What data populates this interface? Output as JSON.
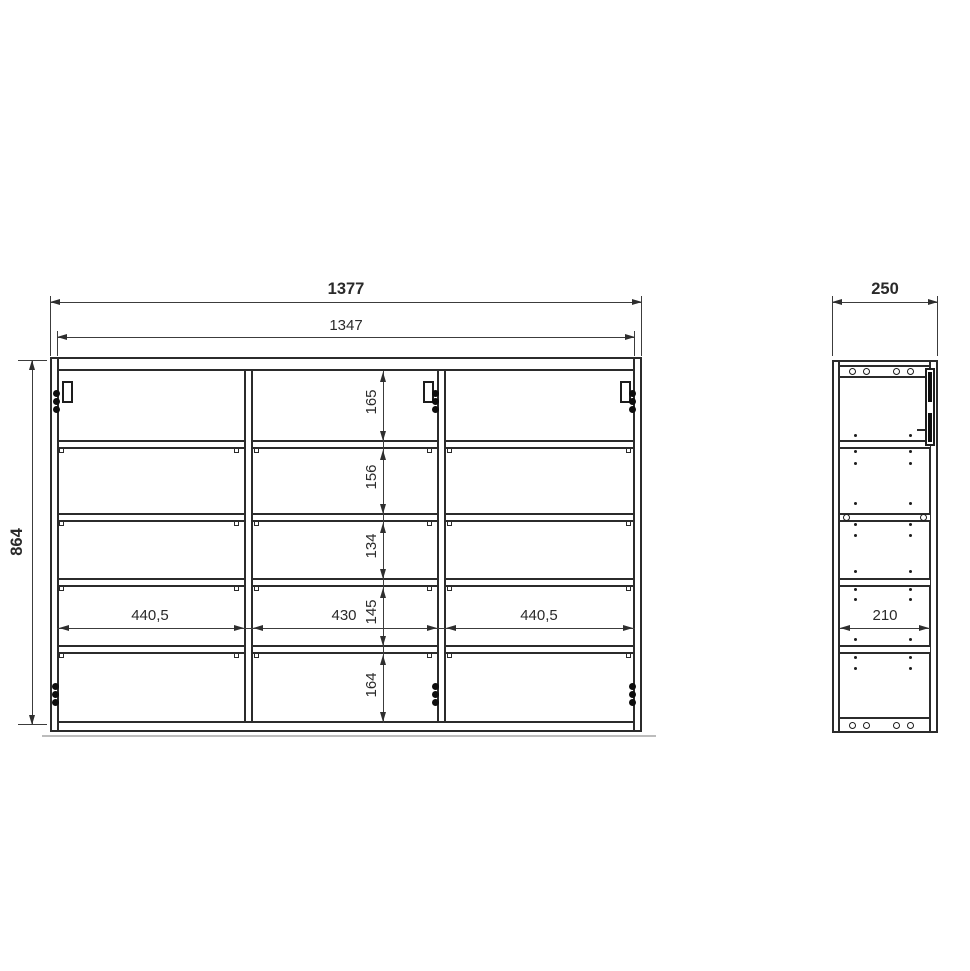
{
  "front_view": {
    "outer_width": "1377",
    "inner_width": "1347",
    "height": "864",
    "column_widths": [
      "440,5",
      "430",
      "440,5"
    ],
    "row_heights": [
      "165",
      "156",
      "134",
      "145",
      "164"
    ]
  },
  "side_view": {
    "width": "250",
    "inner_depth": "210"
  },
  "colors": {
    "line": "#2b2b2b",
    "dimension": "#3c3c3c",
    "background": "#ffffff"
  }
}
